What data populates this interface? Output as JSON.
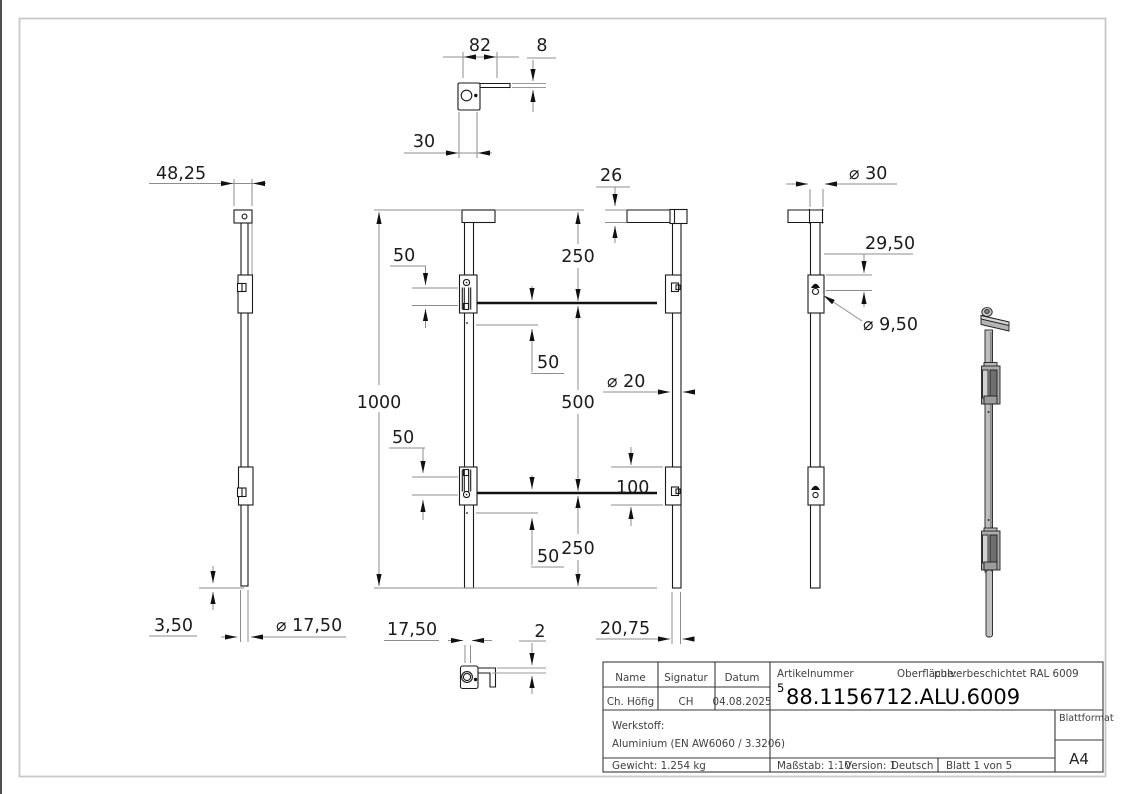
{
  "views": {
    "top": {
      "width": "82",
      "thickness": "8",
      "offset": "30"
    },
    "side": {
      "cap_width": "48,25",
      "tip_offset": "3,50",
      "tip_diameter": "⌀ 17,50"
    },
    "front": {
      "total_length": "1000",
      "top_to_guide": "250",
      "guide_span": "500",
      "guide_to_bottom": "250",
      "inset_upper_left": "50",
      "inset_upper_right": "50",
      "inset_lower_left": "50",
      "inset_lower_right": "50"
    },
    "bottom": {
      "offset": "17,50",
      "lip_thickness": "2"
    },
    "rear": {
      "bar_height": "26",
      "rod_diameter": "⌀ 20",
      "guide_height": "100",
      "tip_offset": "20,75"
    },
    "side_right": {
      "knob_diameter": "⌀ 30",
      "hole_offset": "29,50",
      "hole_diameter": "⌀ 9,50"
    }
  },
  "title_block": {
    "name_label": "Name",
    "signature_label": "Signatur",
    "date_label": "Datum",
    "name_value": "Ch. Höfig",
    "signature_value": "CH",
    "date_value": "04.08.2025",
    "article_label": "Artikelnummer",
    "surface_label": "Oberfläche:",
    "surface_value": "pulverbeschichtet RAL 6009",
    "article_index": "5",
    "article_number": "88.1156712.ALU.6009",
    "material_label": "Werkstoff:",
    "material_value": "Aluminium (EN AW6060 / 3.3206)",
    "weight": "Gewicht: 1.254 kg",
    "scale": "Maßstab: 1:10",
    "version": "Version: 1",
    "language": "Deutsch",
    "sheet": "Blatt 1 von 5",
    "format_label": "Blattformat",
    "format_value": "A4"
  }
}
